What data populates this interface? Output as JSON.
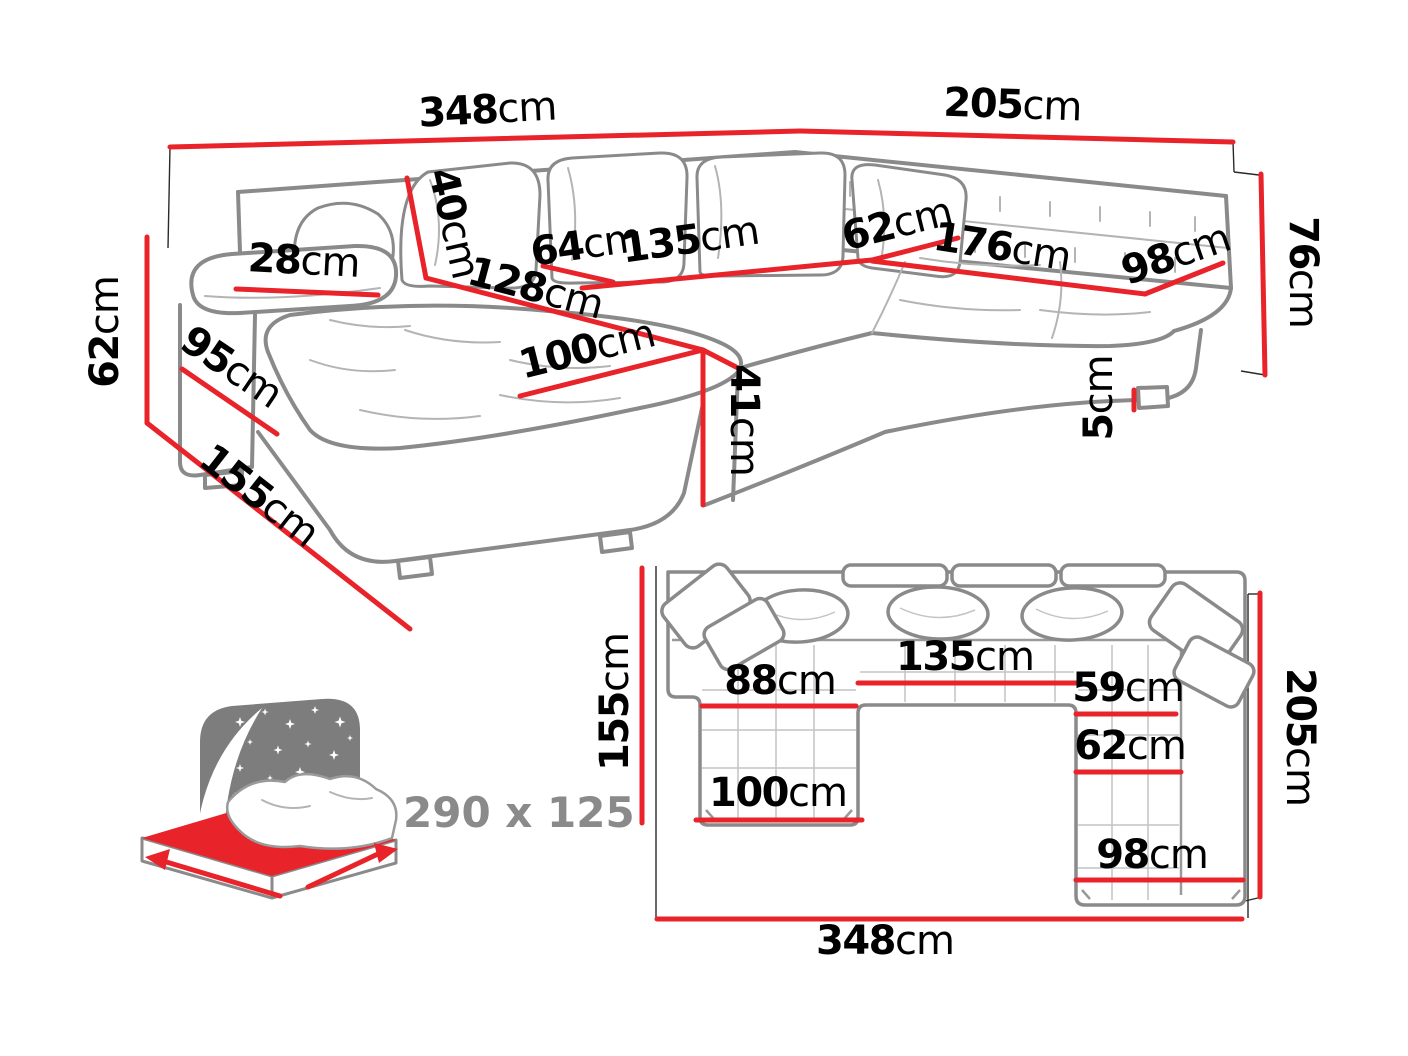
{
  "perspective_view": {
    "dimensions": {
      "total_width_left": {
        "value": "348",
        "unit": "cm"
      },
      "total_width_right": {
        "value": "205",
        "unit": "cm"
      },
      "back_cushion": {
        "value": "40",
        "unit": "cm"
      },
      "armrest_width": {
        "value": "28",
        "unit": "cm"
      },
      "seat_segment_left": {
        "value": "64",
        "unit": "cm"
      },
      "middle_seat_width": {
        "value": "135",
        "unit": "cm"
      },
      "chaise_inner_length": {
        "value": "128",
        "unit": "cm"
      },
      "right_seat_depth": {
        "value": "62",
        "unit": "cm"
      },
      "right_seat_length": {
        "value": "176",
        "unit": "cm"
      },
      "right_end_width": {
        "value": "98",
        "unit": "cm"
      },
      "backrest_height": {
        "value": "76",
        "unit": "cm"
      },
      "leg_height": {
        "value": "5",
        "unit": "cm"
      },
      "armrest_height": {
        "value": "62",
        "unit": "cm"
      },
      "armrest_depth": {
        "value": "95",
        "unit": "cm"
      },
      "chaise_total_length": {
        "value": "155",
        "unit": "cm"
      },
      "chaise_width": {
        "value": "100",
        "unit": "cm"
      },
      "seat_height": {
        "value": "41",
        "unit": "cm"
      }
    }
  },
  "sleeping_function": {
    "dimensions_label": "290 x 125"
  },
  "top_view": {
    "dimensions": {
      "left_depth": {
        "value": "155",
        "unit": "cm"
      },
      "chaise_seat_width": {
        "value": "88",
        "unit": "cm"
      },
      "middle_seat_width": {
        "value": "135",
        "unit": "cm"
      },
      "right_seat_width": {
        "value": "59",
        "unit": "cm"
      },
      "right_seat_width_lower": {
        "value": "62",
        "unit": "cm"
      },
      "chaise_width": {
        "value": "100",
        "unit": "cm"
      },
      "right_unit_width": {
        "value": "98",
        "unit": "cm"
      },
      "right_depth": {
        "value": "205",
        "unit": "cm"
      },
      "total_width": {
        "value": "348",
        "unit": "cm"
      }
    }
  },
  "colors": {
    "dimension_red": "#e8232a",
    "label_text": "#000000",
    "sofa_outline": "#8a8a8a",
    "icon_gray": "#7d7d7d"
  }
}
